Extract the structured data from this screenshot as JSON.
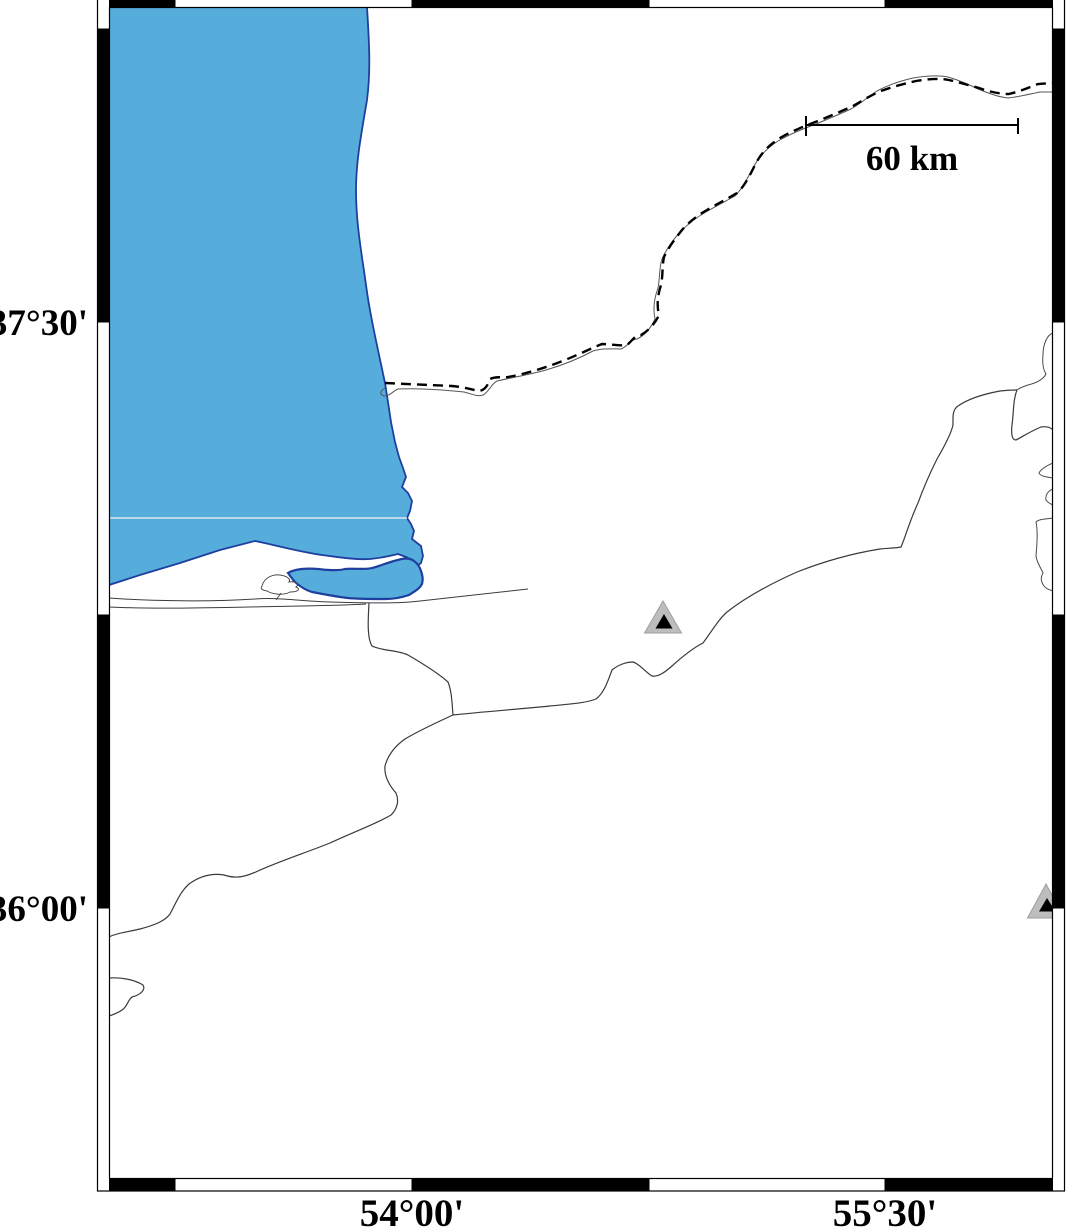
{
  "map": {
    "title": "coastal map of the south-east Caspian Sea region",
    "y_axis_labels": [
      {
        "text": "37°30'"
      },
      {
        "text": "36°00'"
      }
    ],
    "x_axis_labels": [
      {
        "text": "54°00'"
      },
      {
        "text": "55°30'"
      }
    ],
    "scale_bar": {
      "label": "60 km"
    },
    "markers": [
      {
        "name": "station-triangle-1",
        "style": "gray triangle with black core",
        "approx": "center of map"
      },
      {
        "name": "station-triangle-2",
        "style": "gray triangle with black core, clipped by right frame",
        "approx": "right edge near 36°00'"
      }
    ],
    "features": {
      "sea": "Caspian Sea (blue, upper left)",
      "bay": "Gorgan Bay lagoon behind sand spit",
      "border": "dashed international boundary with companion river",
      "rivers": "river network joining at a junction, flowing to bay and southwest"
    },
    "colors": {
      "sea_fill": "#56ACDB",
      "water_outline": "#1E3F9E",
      "land_line": "#3C3C3C",
      "river_line": "#3A3A3A",
      "border_dash": "#000000",
      "triangle_gray": "#BDBDBD",
      "triangle_core": "#000000",
      "frame_black": "#000000",
      "frame_white": "#FFFFFF",
      "grid_seam": "#DEE8F0"
    }
  }
}
